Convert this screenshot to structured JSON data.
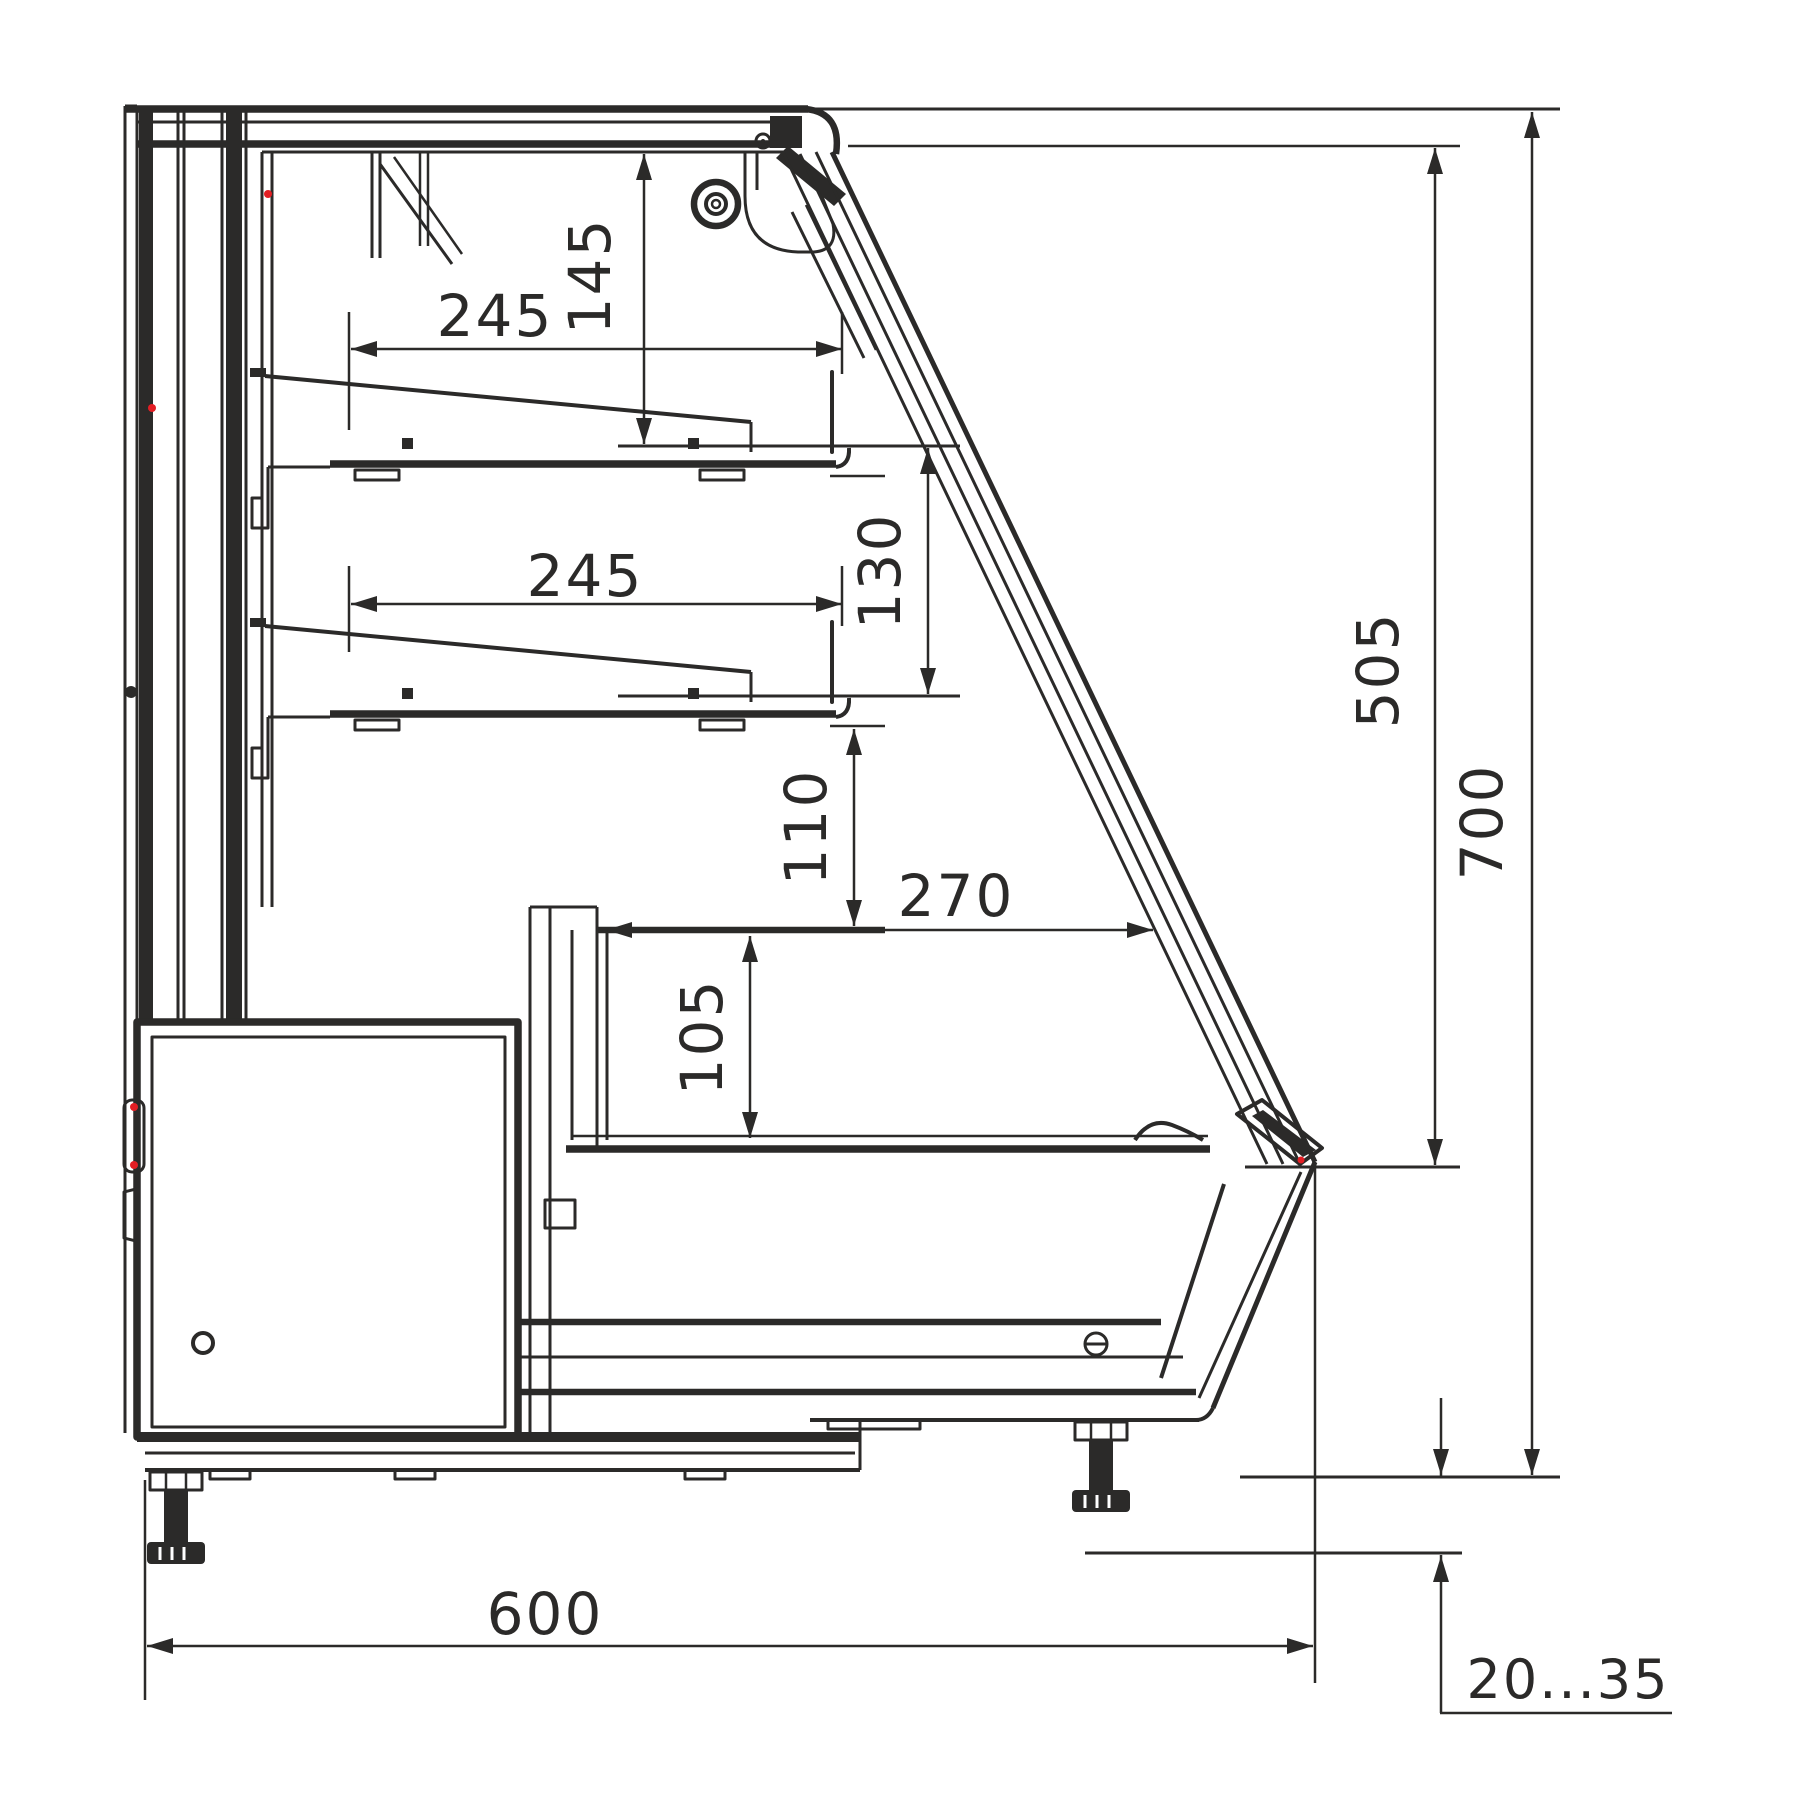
{
  "drawing": {
    "kind": "display-case-side-section",
    "line_color": "#2b2a29",
    "accent_color": "#e31e24",
    "background": "#ffffff"
  },
  "dims": {
    "shelf_upper_depth": {
      "label": "245"
    },
    "canopy_to_shelf": {
      "label": "145"
    },
    "shelf_lower_depth": {
      "label": "245"
    },
    "shelf_spacing": {
      "label": "130"
    },
    "shelf_to_counter": {
      "label": "110"
    },
    "well_width": {
      "label": "270"
    },
    "well_depth": {
      "label": "105"
    },
    "glass_height": {
      "label": "505"
    },
    "overall_height": {
      "label": "700"
    },
    "overall_depth": {
      "label": "600"
    },
    "feet_range": {
      "label": "20...35"
    }
  }
}
